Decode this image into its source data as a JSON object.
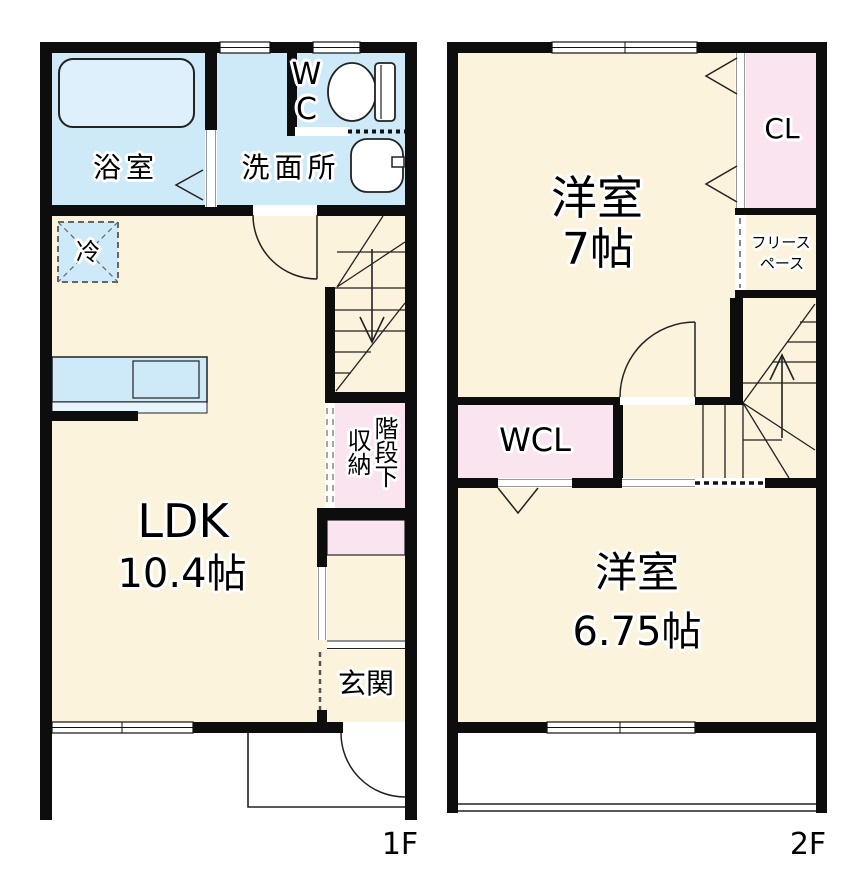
{
  "palette": {
    "room_cream": "#FCF3DD",
    "wet_area_blue": "#CEE9F8",
    "closet_pink": "#F9E4F0",
    "wall_black": "#0D0D0D",
    "line_dark": "#222222",
    "dash_gray": "#888888"
  },
  "floor1": {
    "floor_label": "1F",
    "bath": "浴室",
    "washroom": "洗面所",
    "toilet": "WC",
    "fridge": "冷",
    "ldk_name": "LDK",
    "ldk_size": "10.4帖",
    "stair_storage_line1": "階段下",
    "stair_storage_line2": "収納",
    "entrance": "玄関"
  },
  "floor2": {
    "floor_label": "2F",
    "bedroom1_name": "洋室",
    "bedroom1_size": "7帖",
    "closet": "CL",
    "free_space_line1": "フリース",
    "free_space_line2": "ペース",
    "walkin_closet": "WCL",
    "bedroom2_name": "洋室",
    "bedroom2_size": "6.75帖"
  }
}
